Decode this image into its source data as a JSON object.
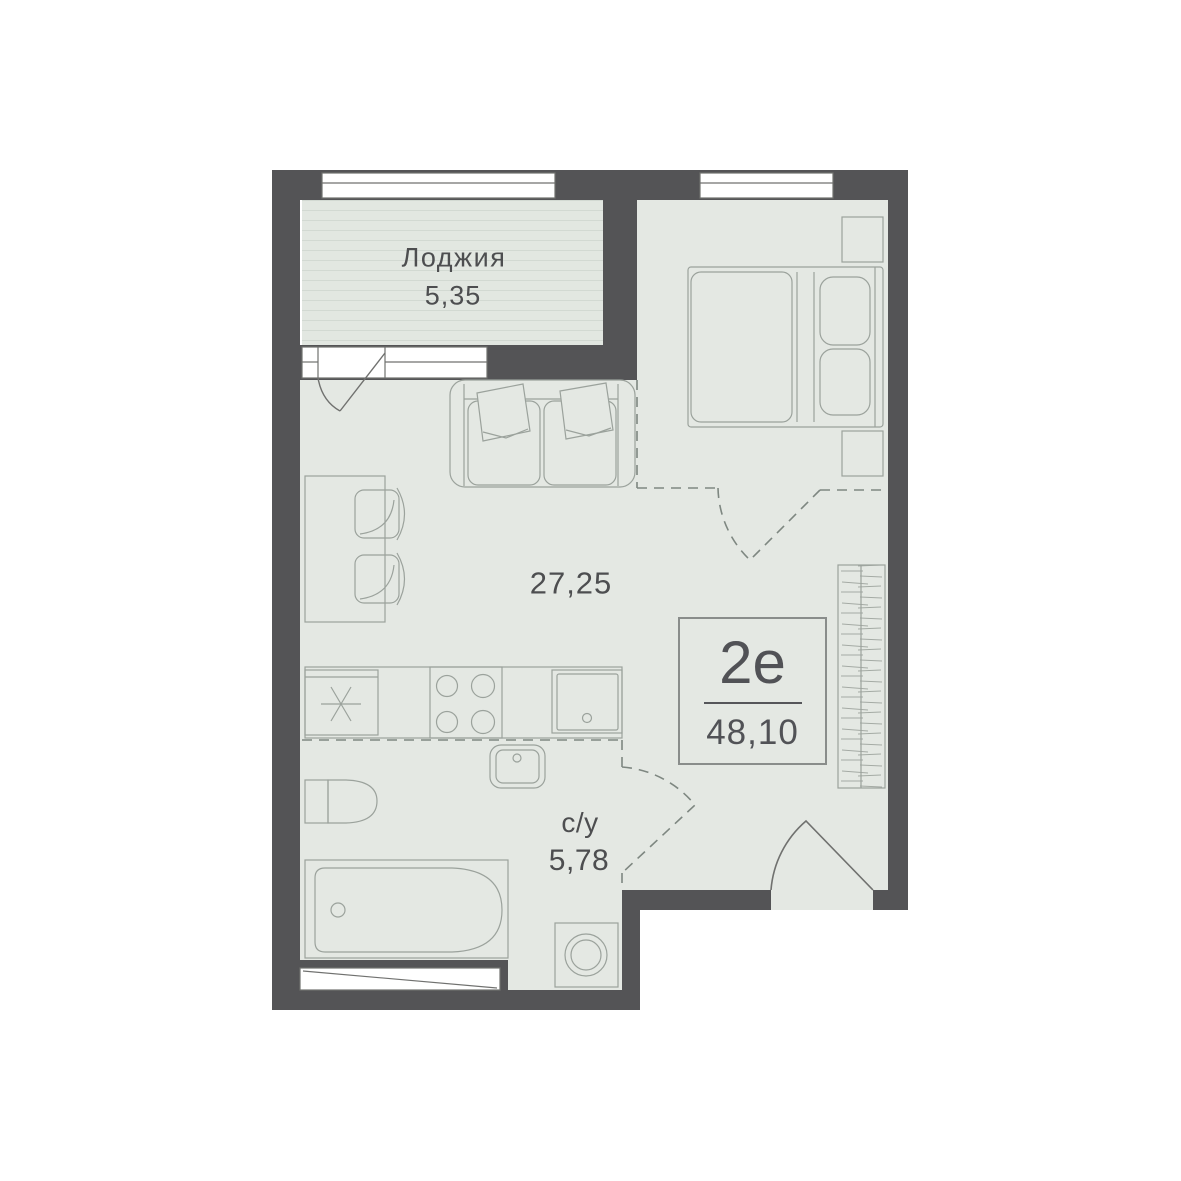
{
  "plan": {
    "loggia": {
      "name": "Лоджия",
      "area": "5,35"
    },
    "living": {
      "area": "27,25"
    },
    "bathroom": {
      "name": "с/у",
      "area": "5,78"
    },
    "unit": {
      "type": "2е",
      "area": "48,10"
    },
    "colors": {
      "wall": "#545456",
      "floor": "#e4e8e3",
      "loggia_stripe": "#d2d9d2",
      "furniture_line": "#9ba29c",
      "door_line": "#70716f",
      "dashed_partition": "#7e8781",
      "text": "#4d4e50",
      "window": "#ffffff"
    }
  }
}
